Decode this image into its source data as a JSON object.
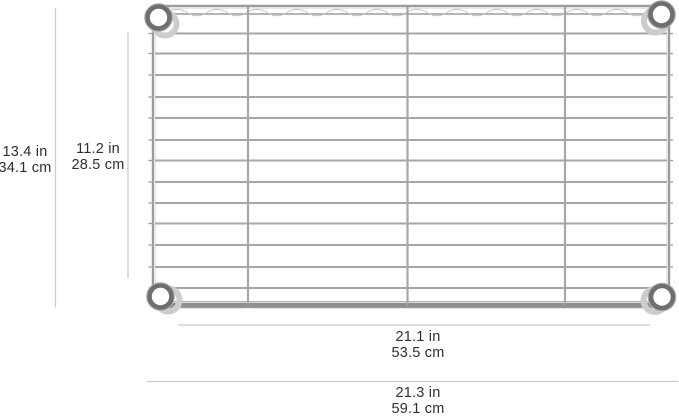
{
  "page": {
    "background_color": "#ffffff"
  },
  "diagram": {
    "kind": "product dimension diagram",
    "subject": "chrome wire shelf, top view with corner collars",
    "text_color": "#2f2f2f",
    "dimension_line_color": "#cbcbcb",
    "shelf_colors": {
      "wire": "#a6a6a6",
      "frame": "#9b9b9b",
      "collar_ring": "#686868",
      "collar_sleeve": "#cdcdcd"
    },
    "dimensions": {
      "outer_height": {
        "label_in": "13.4 in",
        "label_cm": "34.1 cm"
      },
      "inner_height": {
        "label_in": "11.2 in",
        "label_cm": "28.5 cm"
      },
      "inner_width": {
        "label_in": "21.1 in",
        "label_cm": "53.5 cm"
      },
      "outer_width": {
        "label_in": "21.3 in",
        "label_cm": "59.1 cm"
      }
    }
  }
}
